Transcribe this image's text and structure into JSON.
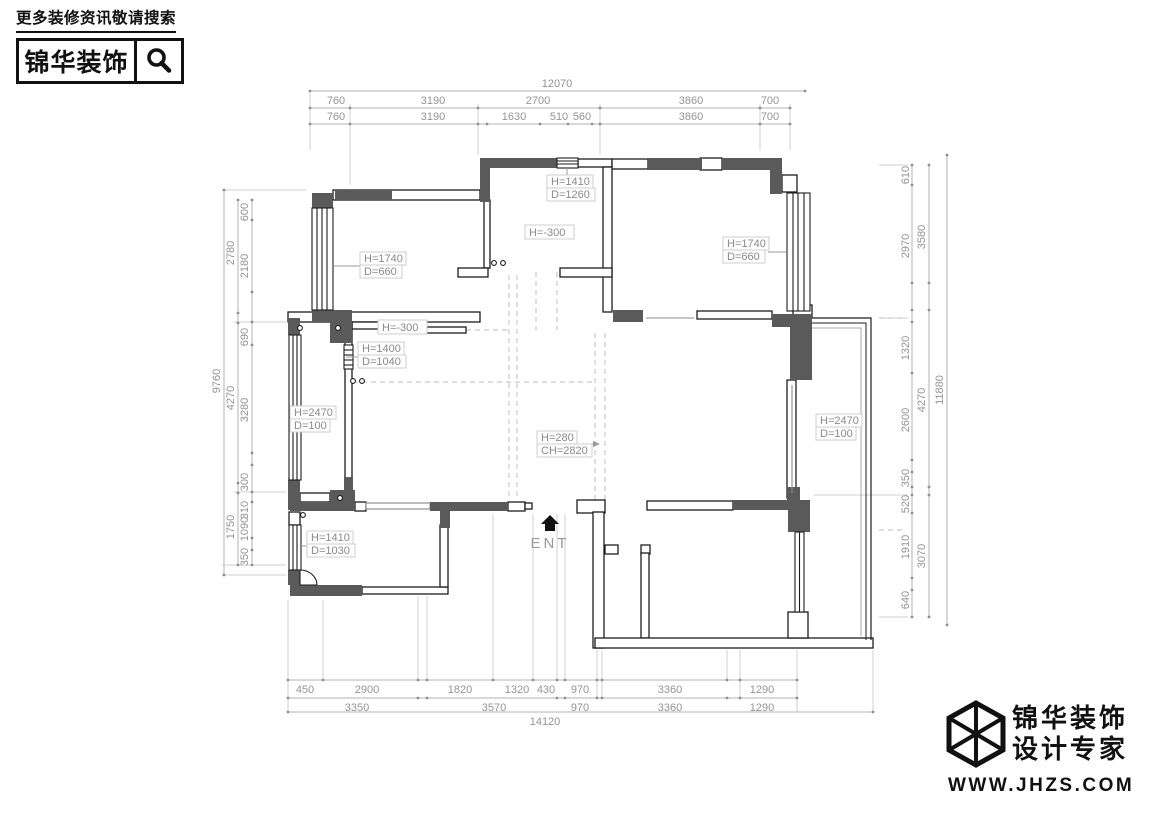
{
  "header": {
    "tagline": "更多装修资讯敬请搜索",
    "brand": "锦华装饰"
  },
  "footer": {
    "brand_line1": "锦华装饰",
    "brand_line2": "设计专家",
    "website": "WWW.JHZS.COM"
  },
  "plan": {
    "ent": "ENT",
    "annotations": [
      {
        "l1": "H=1410",
        "l2": "D=1260"
      },
      {
        "l1": "H=-300"
      },
      {
        "l1": "H=1740",
        "l2": "D=660"
      },
      {
        "l1": "H=1740",
        "l2": "D=660"
      },
      {
        "l1": "H=-300"
      },
      {
        "l1": "H=1400",
        "l2": "D=1040"
      },
      {
        "l1": "H=2470",
        "l2": "D=100"
      },
      {
        "l1": "H=280",
        "l2": "CH=2820"
      },
      {
        "l1": "H=2470",
        "l2": "D=100"
      },
      {
        "l1": "H=1410",
        "l2": "D=1030"
      }
    ]
  },
  "dims": {
    "top": {
      "overall": "12070",
      "row1": [
        "760",
        "3190",
        "2700",
        "3860",
        "700"
      ],
      "row2": [
        "760",
        "3190",
        "1630",
        "510",
        "560",
        "3860",
        "700"
      ]
    },
    "bottom": {
      "row1": [
        "450",
        "2900",
        "1820",
        "1320",
        "430",
        "970",
        "3360",
        "1290"
      ],
      "row2": [
        "3350",
        "3570",
        "970",
        "3360",
        "1290"
      ],
      "overall": "14120"
    },
    "left": {
      "overall": "9760",
      "mid": [
        "2780",
        "4270",
        "1750"
      ],
      "inner": [
        "600",
        "2180",
        "690",
        "3280",
        "300",
        "310",
        "1090",
        "350"
      ]
    },
    "right": {
      "outer": "11880",
      "mid": [
        "3580",
        "4270",
        "3070"
      ],
      "inner": [
        "610",
        "2970",
        "1320",
        "2600",
        "350",
        "520",
        "1910",
        "640"
      ]
    }
  }
}
